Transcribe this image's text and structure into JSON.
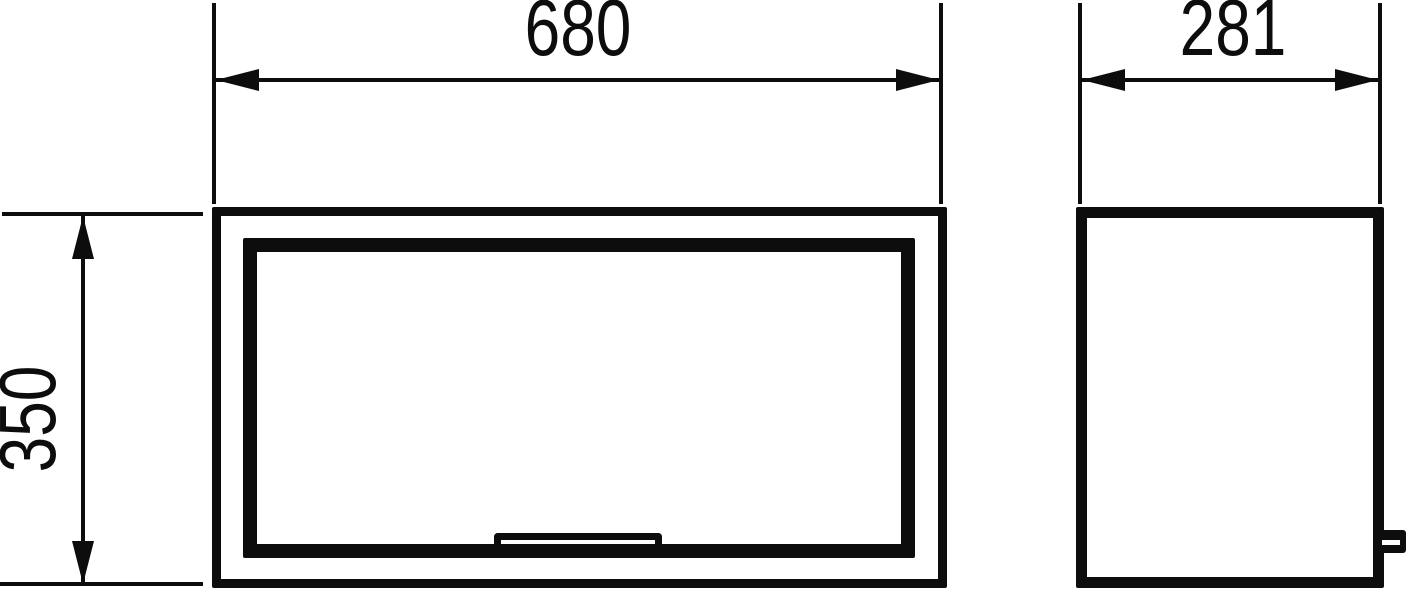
{
  "drawing": {
    "background_color": "#ffffff",
    "line_color": "#0d0d0d",
    "dimensions": [
      {
        "id": "front-width",
        "value": "680",
        "orientation": "horizontal"
      },
      {
        "id": "side-depth",
        "value": "281",
        "orientation": "horizontal"
      },
      {
        "id": "front-height",
        "value": "350",
        "orientation": "vertical"
      }
    ]
  }
}
